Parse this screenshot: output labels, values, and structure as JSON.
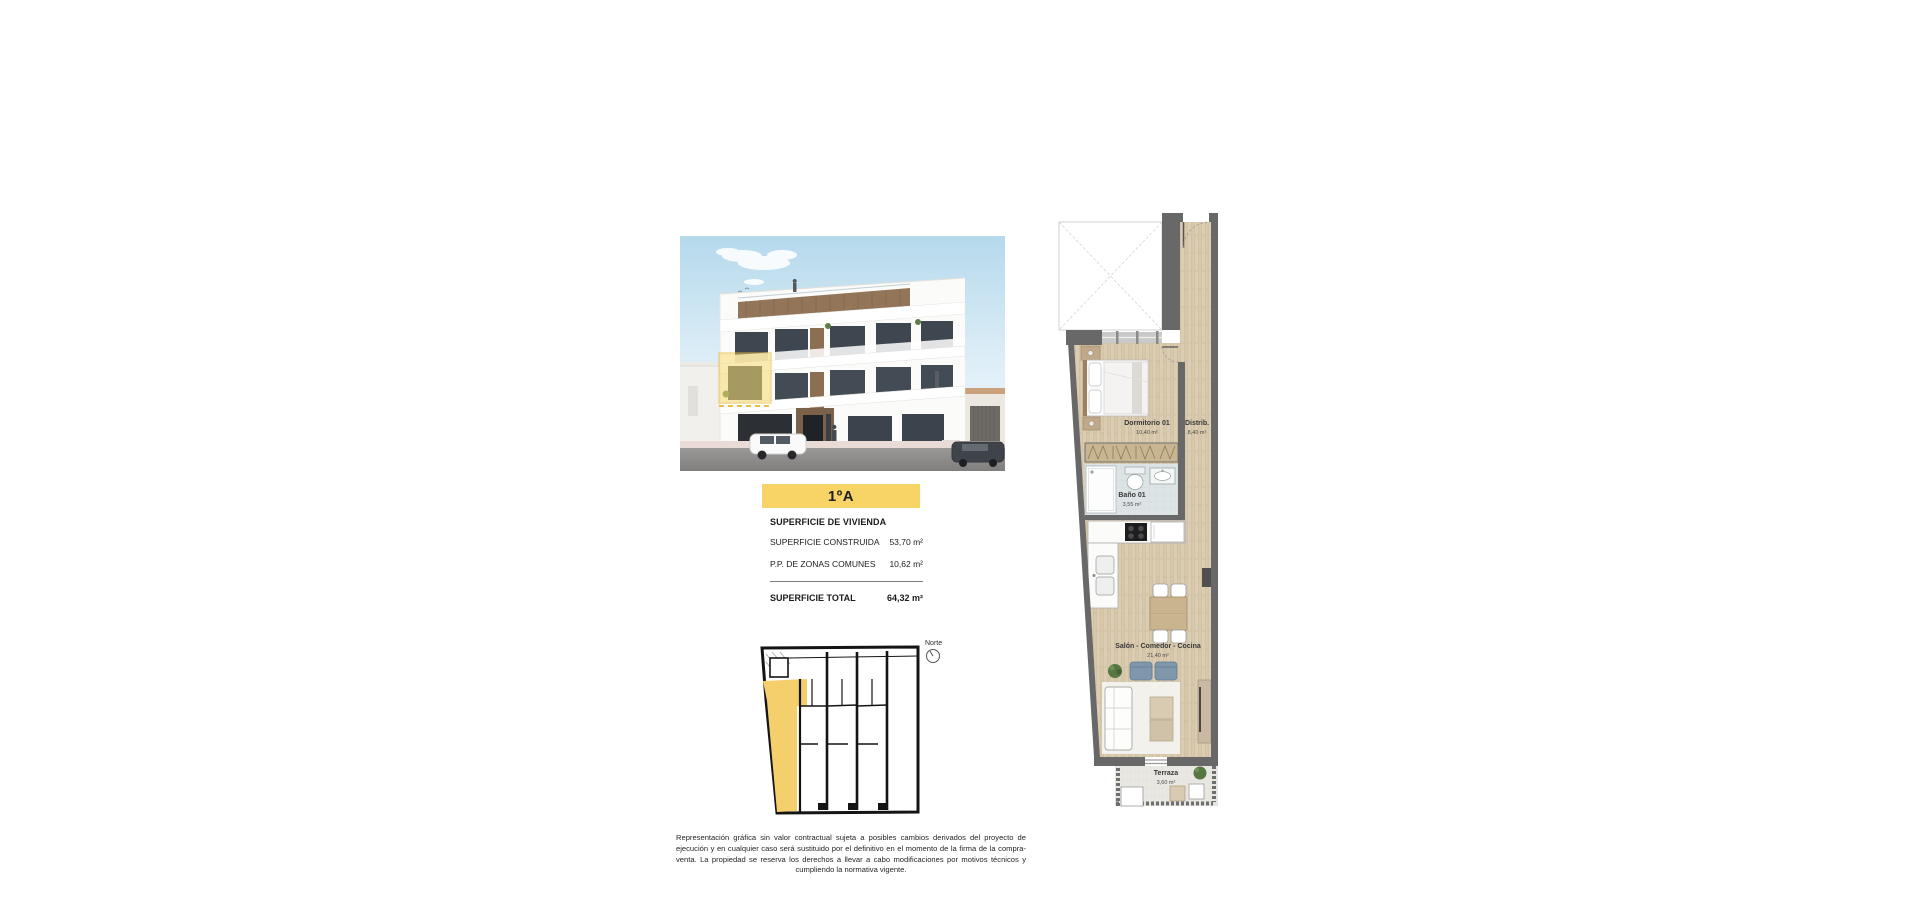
{
  "unit_banner": {
    "label": "1ºA"
  },
  "surface_summary": {
    "title": "SUPERFICIE DE VIVIENDA",
    "rows": [
      {
        "label": "SUPERFICIE CONSTRUIDA",
        "value": "53,70 m²"
      },
      {
        "label": "P.P. DE ZONAS COMUNES",
        "value": "10,62 m²"
      }
    ],
    "total": {
      "label": "SUPERFICIE TOTAL",
      "value": "64,32 m²"
    }
  },
  "site_plan": {
    "north_label": "Norte"
  },
  "floor_plan": {
    "rooms": [
      {
        "name": "Dormitorio 01",
        "area": "10,40 m²"
      },
      {
        "name": "Distrib.",
        "area": "8,40 m²"
      },
      {
        "name": "Baño 01",
        "area": "3,55 m²"
      },
      {
        "name": "Salón - Comedor - Cocina",
        "area": "21,40 m²"
      },
      {
        "name": "Terraza",
        "area": "3,60 m²"
      }
    ]
  },
  "disclaimer": {
    "text": "Representación gráfica sin valor contractual sujeta a posibles cambios derivados del proyecto de ejecución y en cualquier caso será sustituido por el definitivo en el momento de la firma de la compra-venta. La propiedad se reserva los derechos a llevar a cabo modificaciones por motivos técnicos y cumpliendo la normativa vigente."
  },
  "colors": {
    "accent_yellow": "#f8d466",
    "highlight_yellow": "#f7d96e",
    "wall_gray": "#686868",
    "wood_floor": "#dbcdb3",
    "bath_tile": "#dde4e6",
    "terrace_tile": "#e9e7e2"
  }
}
